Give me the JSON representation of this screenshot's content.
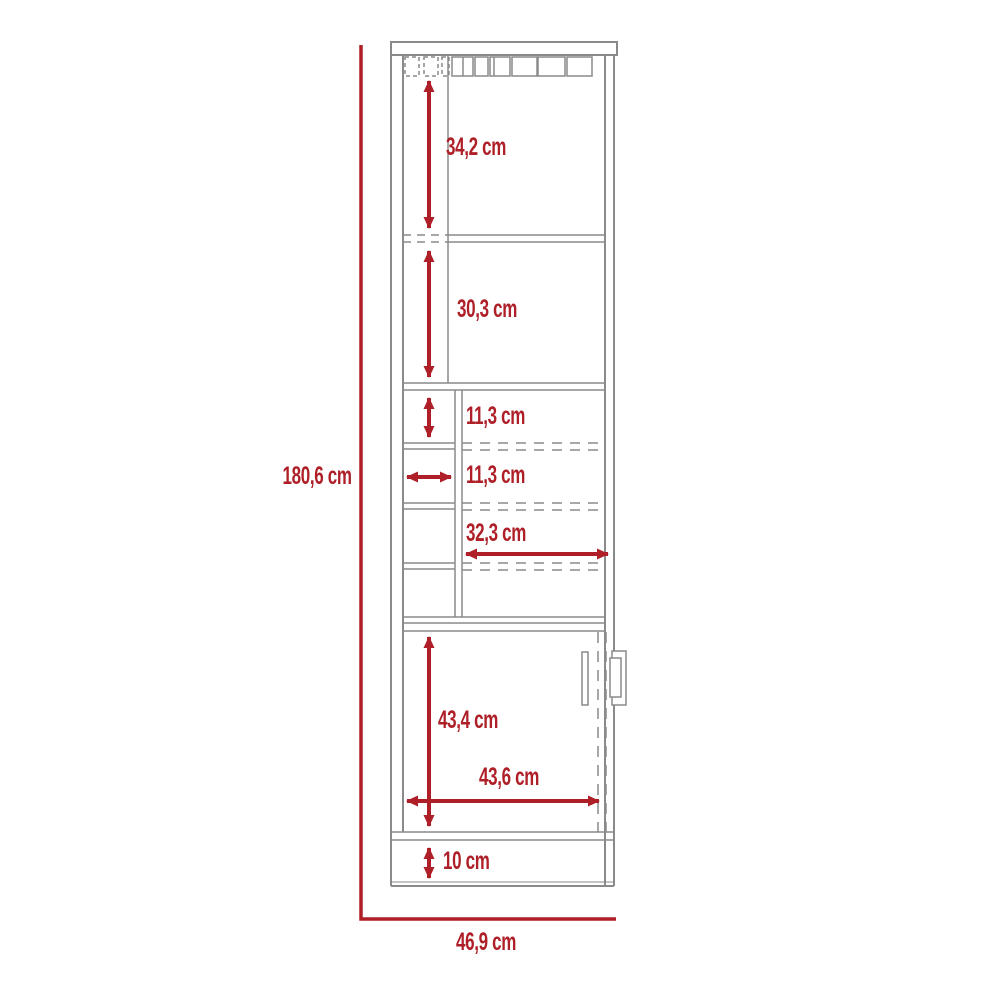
{
  "diagram": {
    "kind": "furniture dimensional drawing, front elevation",
    "subject": "tall bar cabinet with stemware rack, open shelves, wine cubbies, lower door and plinth",
    "unit": "cm",
    "accent_color": "#AE1F28",
    "line_color": "#8A8A8A",
    "background_color": "#FFFFFF",
    "labels": {
      "total_height": "180,6 cm",
      "total_width": "46,9 cm",
      "top_section": "34,2 cm",
      "middle_section": "30,3 cm",
      "cubby_height": "11,3 cm",
      "cubby_width": "11,3 cm",
      "shelf_width": "32,3 cm",
      "door_height": "43,4 cm",
      "door_width": "43,6 cm",
      "base_height": "10 cm"
    },
    "measurements": {
      "total_height_cm": 180.6,
      "total_width_cm": 46.9,
      "top_section_height_cm": 34.2,
      "middle_section_height_cm": 30.3,
      "cubby_height_cm": 11.3,
      "cubby_width_cm": 11.3,
      "interior_shelf_width_cm": 32.3,
      "door_section_height_cm": 43.4,
      "door_section_width_cm": 43.6,
      "base_height_cm": 10
    }
  }
}
